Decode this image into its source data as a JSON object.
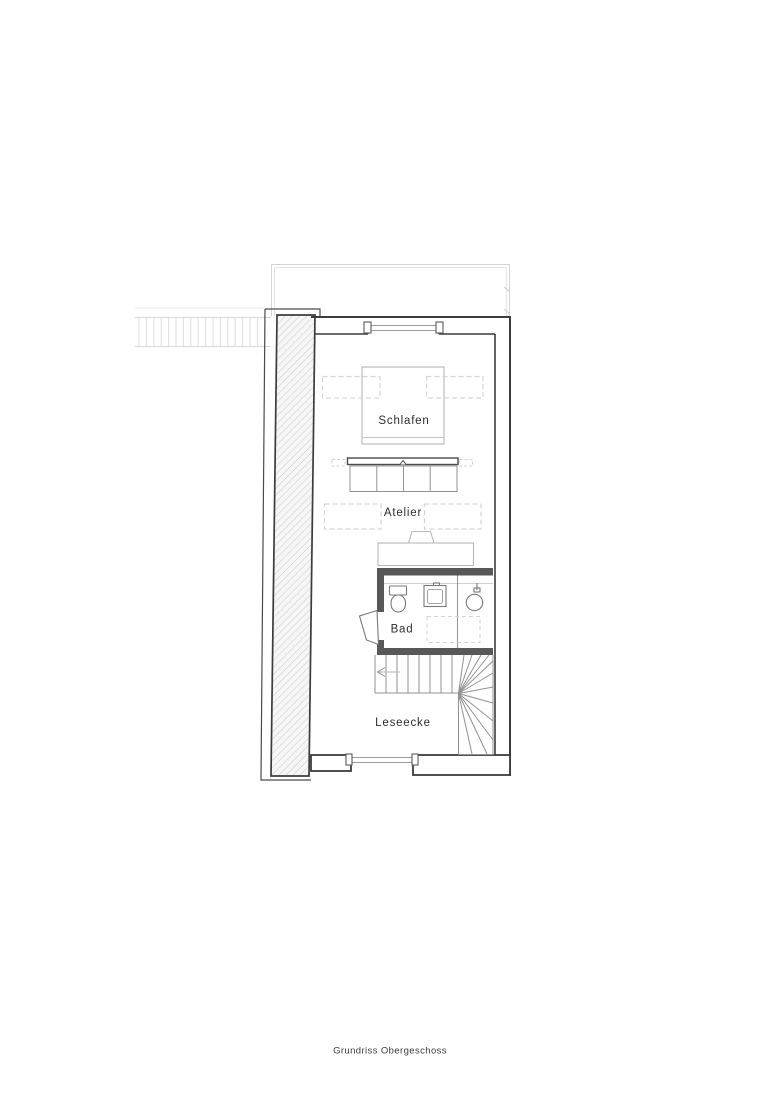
{
  "caption": {
    "text": "Grundriss Obergeschoss"
  },
  "rooms": {
    "schlafen": {
      "label": "Schlafen"
    },
    "atelier": {
      "label": "Atelier"
    },
    "bad": {
      "label": "Bad"
    },
    "leseecke": {
      "label": "Leseecke"
    }
  },
  "drawing": {
    "colors": {
      "background": "#ffffff",
      "wall_line": "#3c3c3c",
      "bath_wall_fill": "#585858",
      "stair_line": "#919191",
      "furniture_line": "#b9b9b9",
      "dashed_overhead_line": "#d6d6d6",
      "hatch_line": "#c9c9c9",
      "neighbor_hatch_line": "#dedede"
    }
  }
}
